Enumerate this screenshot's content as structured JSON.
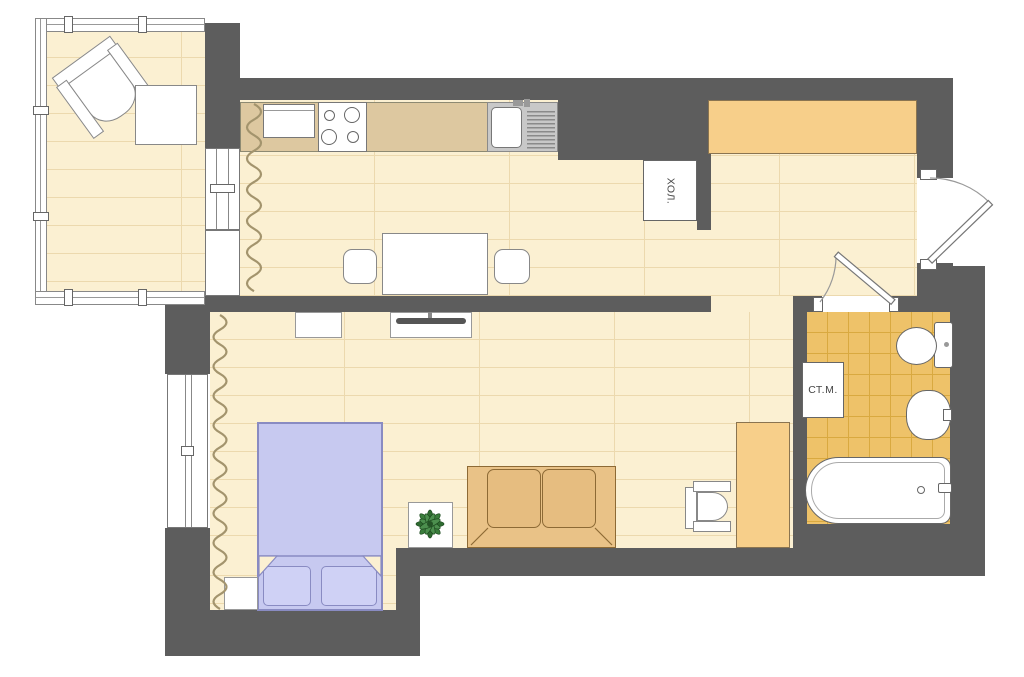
{
  "labels": {
    "fridge": "ХОЛ.",
    "washing_machine": "СТ.М."
  },
  "colors": {
    "wall": "#5d5d5d",
    "floor": "#fbf0d2",
    "floor_line": "#ecd9ae",
    "bath_tile": "#eec269",
    "bath_tile_line": "#d9a940",
    "wardrobe": "#f7cf8a",
    "counter": "#ddc8a0",
    "sofa": "#e9c287",
    "bed": "#c7c9f0",
    "plant": "#2e6b30"
  }
}
